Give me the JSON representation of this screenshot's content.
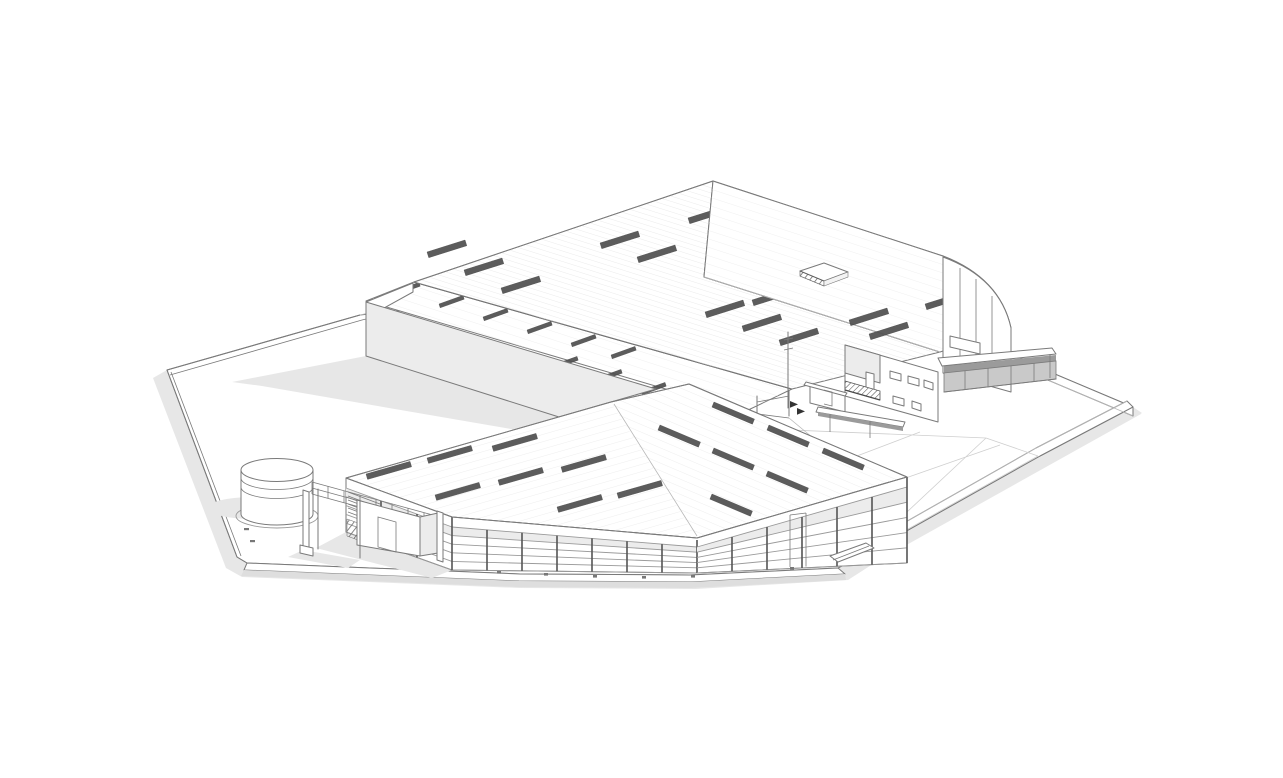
{
  "window": {
    "width": 1283,
    "height": 778,
    "background": "#ffffff"
  },
  "scene": {
    "label": "axonometric line rendering of an industrial warehouse complex on a polygonal site platform",
    "elements": [
      "site-platform",
      "site-drop-shadow",
      "perimeter-curb-walls",
      "rear-left-warehouse",
      "middle-warehouse-roof",
      "main-hall",
      "main-hall-roof-hatch",
      "roof-skylight-strips",
      "office-annex",
      "balcony",
      "entry-porch",
      "loading-canopy",
      "loading-dock-wall",
      "front-warehouse",
      "curtain-wall-glazing",
      "louver-panels",
      "storage-tank",
      "utility-building",
      "pergola-canopy",
      "entrance-gate",
      "paving-triangulation",
      "bollards"
    ]
  },
  "colors": {
    "bg": "#ffffff",
    "line": "#7a7a7a",
    "line-dark": "#4a4a4a",
    "line-light": "#b8b8b8",
    "wall-gray": "#ececec",
    "shadow": "#e7e7e7",
    "shadow-deep": "#dedede",
    "skylight": "#4f4f4f",
    "glass-band": "#ececec",
    "dock": "#c9c9c9",
    "canopy-shadow": "#9b9b9b",
    "mullion": "#555555",
    "rail": "#9a9a9a",
    "ground-line": "#cfcfcf",
    "bollard": "#777777",
    "seam": "#e3e3e3"
  }
}
